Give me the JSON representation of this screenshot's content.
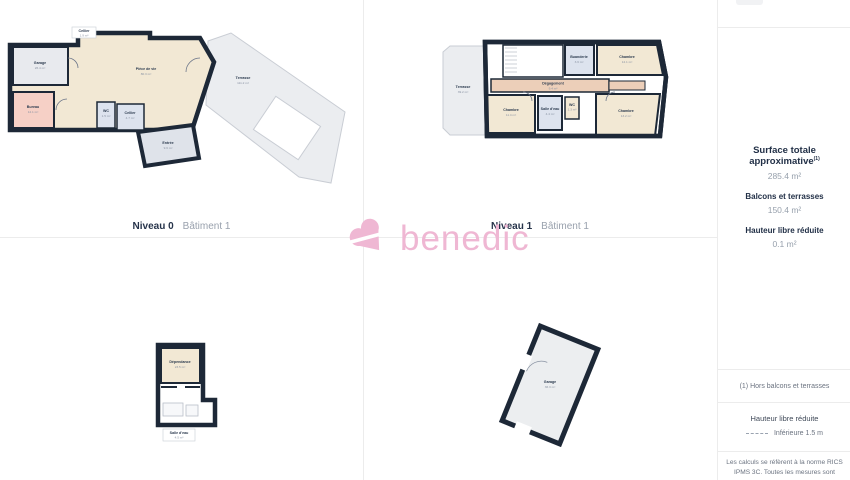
{
  "brand": {
    "name": "benedic"
  },
  "captions": {
    "plan1_level": "Niveau 0",
    "plan1_building": "Bâtiment 1",
    "plan2_level": "Niveau 1",
    "plan2_building": "Bâtiment 1"
  },
  "sidebar": {
    "metrics": [
      {
        "label": "Surface totale approximative",
        "sup": "(1)",
        "value": "285.4 m²"
      },
      {
        "label": "Balcons et terrasses",
        "sup": "",
        "value": "150.4 m²"
      },
      {
        "label": "Hauteur libre réduite",
        "sup": "",
        "value": "0.1 m²"
      }
    ],
    "footnote": "(1) Hors balcons et terrasses",
    "legend_title": "Hauteur libre réduite",
    "legend_item": "Inférieure 1.5 m",
    "disclaimer_line1": "Les calculs se réfèrent à la norme RICS",
    "disclaimer_line2": "IPMS 3C. Toutes les mesures sont"
  },
  "plans": {
    "niveau0": {
      "rooms": [
        {
          "name": "Cellier",
          "area": "1.9 m²"
        },
        {
          "name": "Garage",
          "area": "26.4 m²"
        },
        {
          "name": "Bureau",
          "area": "12.1 m²"
        },
        {
          "name": "Pièce de vie",
          "area": "80.3 m²"
        },
        {
          "name": "WC",
          "area": "1.5 m²"
        },
        {
          "name": "Cellier",
          "area": "4.7 m²"
        },
        {
          "name": "Entrée",
          "area": "9.6 m²"
        },
        {
          "name": "Terrasse",
          "area": "111.2 m²"
        }
      ]
    },
    "niveau1": {
      "rooms": [
        {
          "name": "Terrasse",
          "area": "39.2 m²"
        },
        {
          "name": "Buanderie",
          "area": "3.6 m²"
        },
        {
          "name": "Chambre",
          "area": "12.1 m²"
        },
        {
          "name": "Dégagement",
          "area": "9.4 m²"
        },
        {
          "name": "Chambre",
          "area": "11.4 m²"
        },
        {
          "name": "Salle d'eau",
          "area": "4.4 m²"
        },
        {
          "name": "WC",
          "area": "1.3 m²"
        },
        {
          "name": "Chambre",
          "area": "13.2 m²"
        }
      ]
    },
    "annexe": {
      "rooms": [
        {
          "name": "Dépendance",
          "area": "23.5 m²"
        },
        {
          "name": "Salle d'eau",
          "area": "4.5 m²"
        }
      ]
    },
    "garage_batiment": {
      "rooms": [
        {
          "name": "Garage",
          "area": "36.3 m²"
        }
      ]
    }
  },
  "colors": {
    "brand_pink": "#EFB7D3",
    "wall": "#1D2837",
    "room_beige": "#F2E8D4",
    "room_grey": "#E8EAEE",
    "room_pink": "#F6D0C6",
    "room_blue": "#DDE3EE",
    "corridor_tan": "#ECCFB9",
    "terrace_grey": "#EBEDF0",
    "text_dark": "#26334A",
    "text_muted": "#8A93A3"
  }
}
